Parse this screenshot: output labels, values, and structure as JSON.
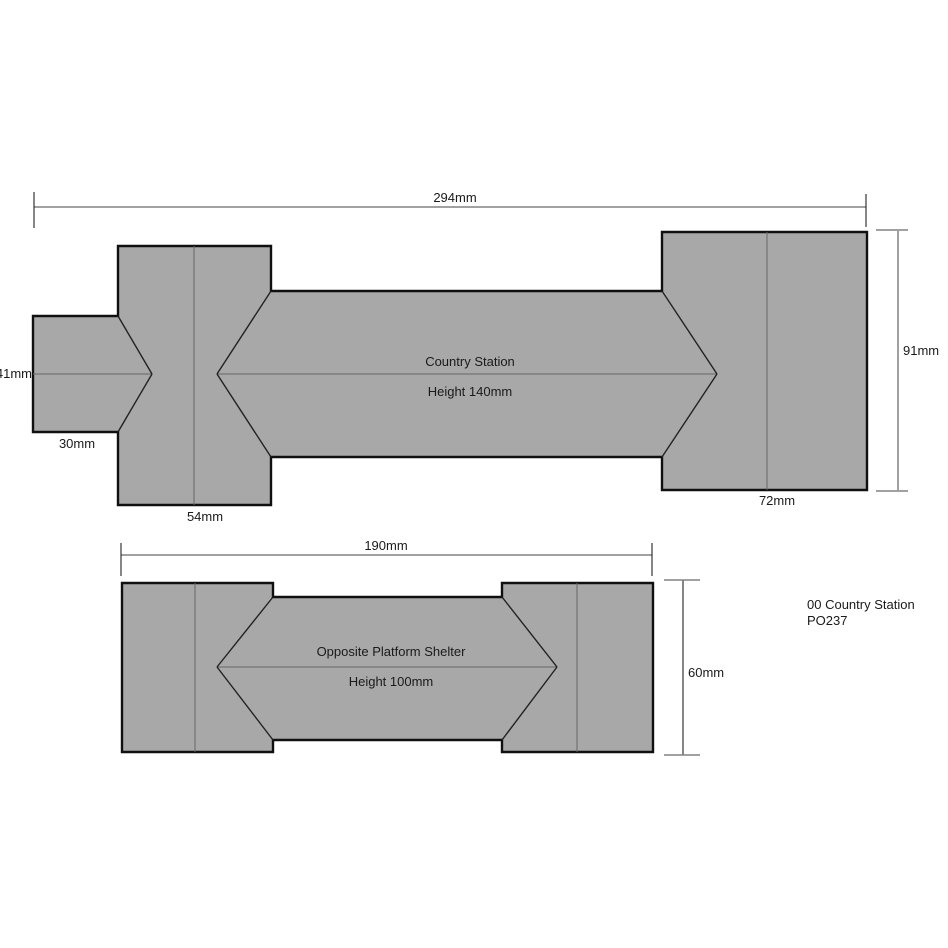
{
  "colors": {
    "background": "#ffffff",
    "roof_fill": "#a8a8a8",
    "outline": "#101010",
    "ridge": "#666666",
    "hip": "#222222",
    "dim_line": "#828282",
    "tick": "#222222",
    "text": "#1a1a1a"
  },
  "station": {
    "label": "Country Station",
    "height_label": "Height 140mm",
    "overall_width_label": "294mm",
    "wing_height_label": "91mm",
    "porch_depth_label": "41mm",
    "porch_width_label": "30mm",
    "left_wing_width_label": "54mm",
    "right_wing_width_label": "72mm"
  },
  "shelter": {
    "label": "Opposite Platform Shelter",
    "height_label": "Height 100mm",
    "overall_width_label": "190mm",
    "depth_label": "60mm"
  },
  "caption": {
    "line1": "00 Country Station",
    "line2": "PO237"
  }
}
